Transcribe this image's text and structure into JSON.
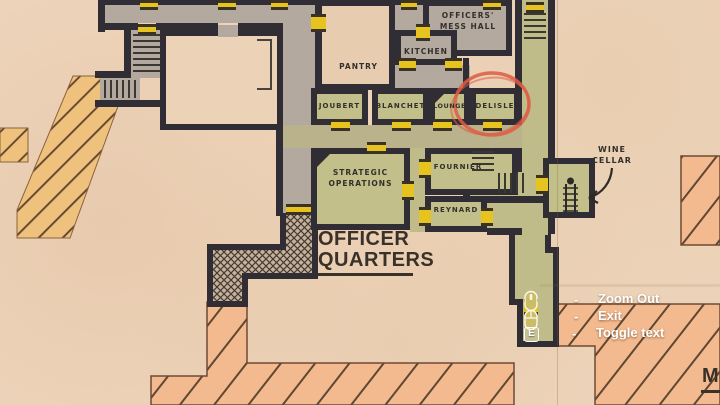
{
  "map": {
    "region_title_line1": "OFFICER",
    "region_title_line2": "QUARTERS",
    "rooms": {
      "mess_hall_line1": "OFFICERS'",
      "mess_hall_line2": "MESS HALL",
      "kitchen": "KITCHEN",
      "pantry": "PANTRY",
      "joubert": "JOUBERT",
      "blanchet": "BLANCHET",
      "lounge": "LOUNGE",
      "delisle": "DELISLE",
      "strategic_line1": "STRATEGIC",
      "strategic_line2": "OPERATIONS",
      "fournier": "FOURNIER",
      "reynard": "REYNARD",
      "wine_cellar_line1": "WINE",
      "wine_cellar_line2": "CELLAR"
    },
    "edge_label": "M",
    "highlight": {
      "room": "DELISLE",
      "color": "#df5b44"
    }
  },
  "hud": {
    "separator": "-",
    "rows": [
      {
        "icon": "mouse-scroll-icon",
        "label": "Zoom Out"
      },
      {
        "icon": "mouse-icon",
        "label": "Exit"
      },
      {
        "icon": "e-key-icon",
        "key": "E",
        "label": "Toggle text"
      }
    ]
  },
  "colors": {
    "paper": "#edd4ba",
    "wall": "#302e34",
    "room_gray": "#b3a99e",
    "room_green": "#c2bf8b",
    "door_gold": "#e6c31f",
    "stairs_orange": "#eec27d",
    "hatch_salmon": "#f3b98f",
    "highlight_red": "#df5b44",
    "hud_text": "#ffffff"
  }
}
